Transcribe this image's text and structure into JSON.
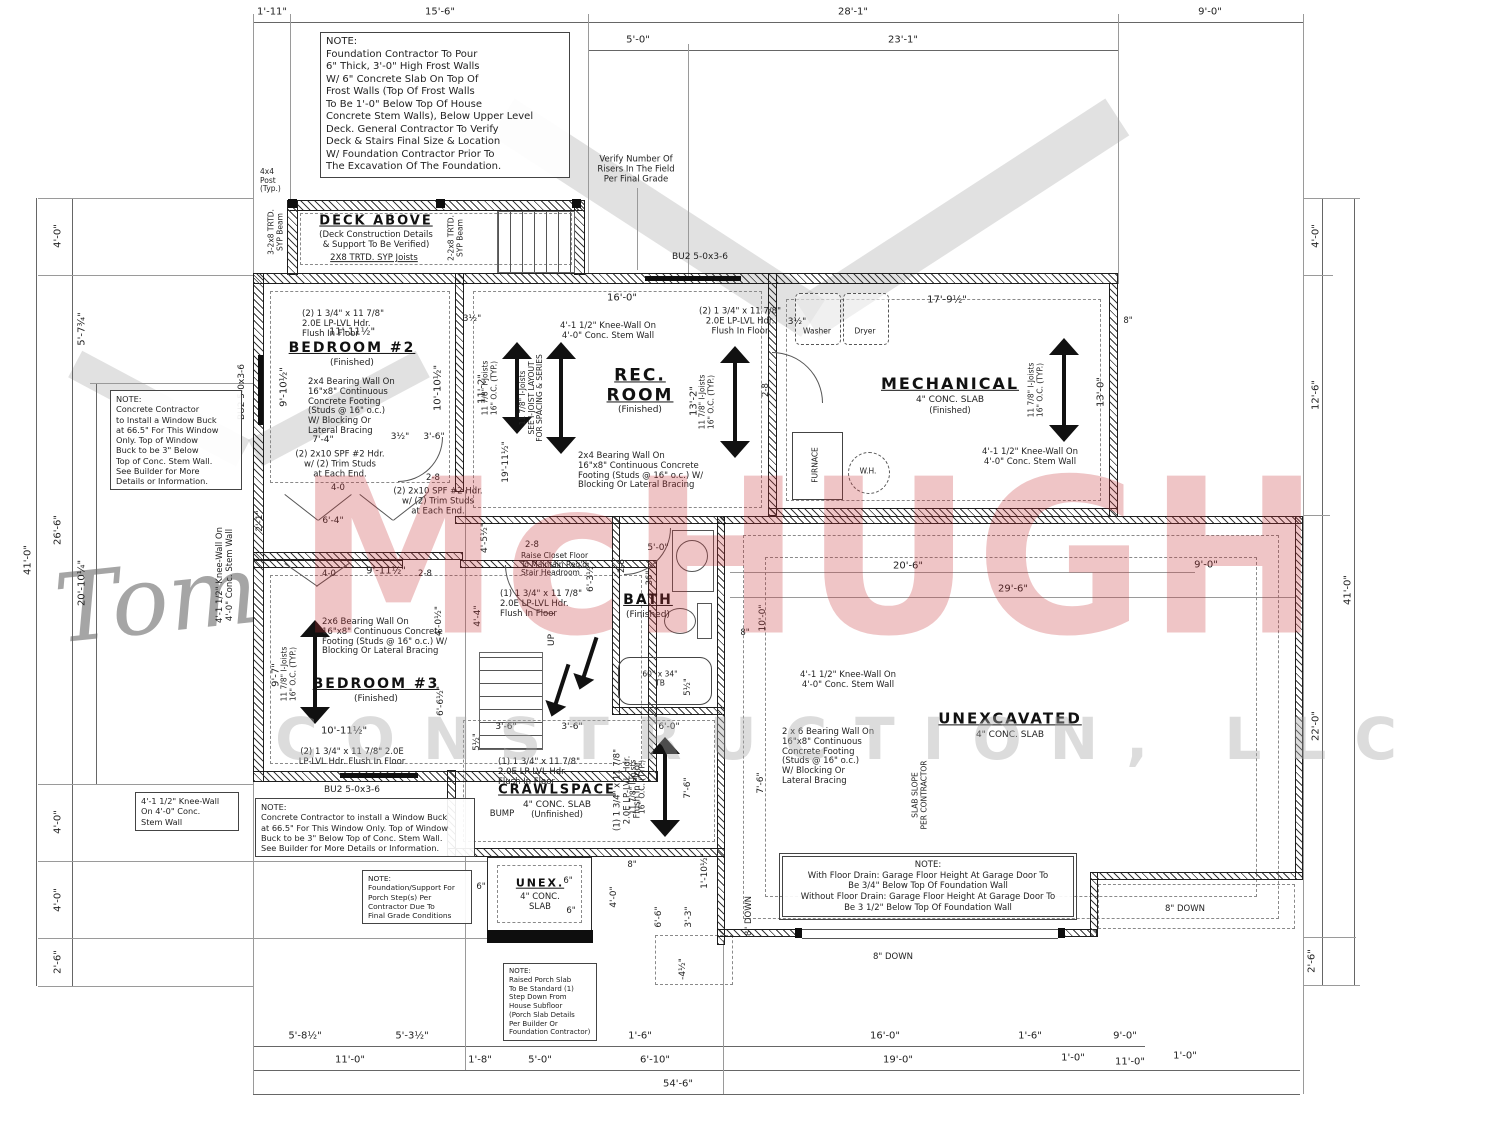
{
  "watermark": {
    "script": "Tom",
    "name": "McHUGH",
    "tagline": "CONSTRUCTION, LLC"
  },
  "deck": {
    "title": "DECK ABOVE",
    "sub": "(Deck Construction Details\n& Support To Be Verified)",
    "joists": "2X8 TRTD. SYP Joists",
    "beam_left": "3-2x8 TRTD.\nSYP Beam",
    "beam_right": "2-2x8 TRTD.\nSYP Beam",
    "post": "4x4\nPost\n(Typ.)"
  },
  "rooms": {
    "bedroom2": {
      "name": "BEDROOM #2",
      "sub": "(Finished)"
    },
    "rec": {
      "name": "REC.\nROOM",
      "sub": "(Finished)"
    },
    "mechanical": {
      "name": "MECHANICAL",
      "sub": "4\" CONC. SLAB",
      "sub2": "(Finished)"
    },
    "bath": {
      "name": "BATH",
      "sub": "(Finished)"
    },
    "bedroom3": {
      "name": "BEDROOM #3",
      "sub": "(Finished)"
    },
    "crawl": {
      "name": "CRAWLSPACE",
      "sub": "4\" CONC. SLAB",
      "sub2": "(Unfinished)"
    },
    "unex": {
      "name": "UNEXCAVATED",
      "sub": "4\" CONC. SLAB"
    },
    "porch": {
      "name": "UNEX.",
      "sub": "4\" CONC.\nSLAB"
    }
  },
  "fixtures": {
    "washer": "Washer",
    "dryer": "Dryer",
    "furnace": "FURNACE",
    "wh": "W.H.",
    "tub": "60\" x 34\"\nTB",
    "up": "UP",
    "bump": "BUMP"
  },
  "notes": {
    "foundation": "NOTE:\nFoundation Contractor To Pour\n6\" Thick, 3'-0\" High Frost Walls\nW/ 6\" Concrete Slab On Top Of\nFrost Walls (Top Of Frost Walls\nTo Be 1'-0\" Below Top Of House\nConcrete Stem Walls), Below Upper Level\nDeck. General Contractor To Verify\nDeck & Stairs Final Size & Location\nW/ Foundation Contractor Prior To\nThe Excavation Of The Foundation.",
    "risers": "Verify Number Of\nRisers In The Field\nPer Final Grade",
    "buck_left": "NOTE:\nConcrete Contractor\nto Install a Window Buck\nat 66.5\" For This Window\nOnly.  Top of Window\nBuck to be 3\" Below\nTop of Conc. Stem Wall.\nSee Builder for More\nDetails or Information.",
    "buck_bottom": "NOTE:\nConcrete Contractor to install a Window Buck\nat 66.5\" For This Window Only.  Top of Window\nBuck to be 3\" Below Top of Conc. Stem Wall.\nSee Builder for More Details or Information.",
    "porch_support": "NOTE:\nFoundation/Support For\nPorch Step(s) Per\nContractor Due To\nFinal Grade Conditions",
    "porch_slab": "NOTE:\nRaised Porch Slab\nTo Be Standard (1)\nStep Down From\nHouse Subfloor\n(Porch Slab Details\nPer Builder Or\nFoundation Contractor)",
    "garage": "NOTE:\nWith Floor Drain: Garage Floor Height At Garage Door To\nBe 3/4\" Below Top Of Foundation Wall\nWithout Floor Drain: Garage Floor Height At Garage Door To\nBe 3 1/2\" Below Top Of Foundation Wall",
    "closet": "Raise Closet Floor\nTo Maintain Req'd\nStair Headroom",
    "slab_slope": "SLAB SLOPE\nPER CONTRACTOR",
    "window_code": "BU2 5-0x3-6"
  },
  "walls": {
    "knee": "4'-1 1/2\" Knee-Wall On\n4'-0\" Conc. Stem Wall",
    "knee_box": "4'-1 1/2\" Knee-Wall\nOn 4'-0\" Conc.\nStem Wall",
    "bw24_a": "2x4 Bearing Wall On\n16\"x8\" Continuous\nConcrete Footing\n(Studs @ 16\" o.c.)\nW/ Blocking Or\nLateral Bracing",
    "bw24_b": "2x4 Bearing Wall On\n16\"x8\" Continuous Concrete\nFooting (Studs @ 16\" o.c.) W/\nBlocking Or Lateral Bracing",
    "bw26_a": "2x6 Bearing Wall On\n16\"x8\" Continuous Concrete\nFooting (Studs @ 16\" o.c.) W/\nBlocking Or Lateral Bracing",
    "bw26_b": "2 x 6 Bearing Wall On\n16\"x8\" Continuous\nConcrete Footing\n(Studs @ 16\" o.c.)\nW/ Blocking Or\nLateral Bracing",
    "hdr2": "(2) 1 3/4\" x 11 7/8\"\n2.0E LP-LVL Hdr.\nFlush In Floor",
    "hdr2_wide": "(2) 1 3/4\" x 11 7/8\" 2.0E\nLP-LVL Hdr. Flush In Floor",
    "hdr1": "(1) 1 3/4\" x 11 7/8\"\n2.0E LP-LVL Hdr.\nFlush In Floor",
    "hdr10": "(2) 2x10 SPF #2 Hdr.\nw/ (2) Trim Studs\nat Each End.",
    "joists": "11 7/8\" I-Joists\n16\" O.C. (TYP.)",
    "joists_see": "11 7/8\" I-Joists\nSEE I-JOIST LAYOUT\nFOR SPACING & SERIES",
    "down8": "8\" DOWN"
  },
  "dims": {
    "t1": [
      "1'-11\"",
      "15'-6\"",
      "28'-1\"",
      "9'-0\""
    ],
    "t2": [
      "5'-0\"",
      "23'-1\""
    ],
    "left": [
      "4'-0\"",
      "5'-7¾\"",
      "26'-6\"",
      "20'-10¼\"",
      "4'-0\"",
      "4'-0\"",
      "2'-6\"",
      "41'-0\""
    ],
    "right": [
      "4'-0\"",
      "12'-6\"",
      "22'-0\"",
      "2'-6\"",
      "41'-0\""
    ],
    "b1": [
      "5'-8½\"",
      "5'-3½\"",
      "1'-6\"",
      "16'-0\"",
      "1'-6\"",
      "9'-0\""
    ],
    "b2": [
      "11'-0\"",
      "1'-8\"",
      "5'-0\"",
      "6'-10\"",
      "19'-0\"",
      "1'-0\"",
      "11'-0\"",
      "1'-0\""
    ],
    "b3": "54'-6\"",
    "i": [
      "11'-11½\"",
      "3½\"",
      "16'-0\"",
      "3½\"",
      "17'-9½\"",
      "9'-10½\"",
      "10'-10½\"",
      "11'-2\"",
      "13'-2\"",
      "13'-0\"",
      "7'-4\"",
      "3½\"",
      "3'-6\"",
      "2-8",
      "4-0",
      "6'-4\"",
      "2'-1\"",
      "9'-11½\"",
      "2-8",
      "4'-0½\"",
      "4'-4\"",
      "4'-5½\"",
      "19'-11½\"",
      "6'-3½\"",
      "9'-7\"",
      "6'-6½\"",
      "10'-11½\"",
      "3'-6\"",
      "3'-6\"",
      "6'-0\"",
      "5'-0\"",
      "36\"",
      "2-8",
      "10'-0\"",
      "20'-6\"",
      "29'-6\"",
      "9'-0\"",
      "7'-6\"",
      "7'-6\"",
      "4'-0\"",
      "6'-6\"",
      "3'-3\"",
      "-4½\"",
      "1'-10½\"",
      "2-8",
      "5½\"",
      "5½\"",
      "4-0",
      "2-8",
      "6\"",
      "6\"",
      "6\"",
      "8\"",
      "8\"",
      "8\""
    ]
  }
}
